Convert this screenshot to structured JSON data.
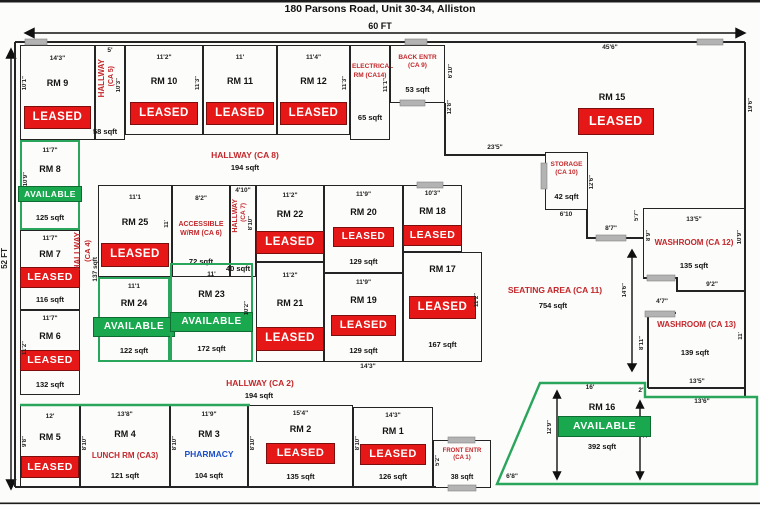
{
  "title": "180 Parsons Road, Unit 30-34, Alliston",
  "overall": {
    "width_label": "60 FT",
    "height_label": "52 FT"
  },
  "hallways": {
    "ca8": {
      "name": "HALLWAY (CA 8)",
      "sqft": "194 sqft"
    },
    "ca2": {
      "name": "HALLWAY (CA 2)",
      "sqft": "194 sqft"
    },
    "ca5": {
      "l1": "HALLWAY",
      "l2": "(CA 5)",
      "top": "5'",
      "side": "10'3\"",
      "sqft": "58 sqft"
    },
    "ca7": {
      "l1": "HALLWAY",
      "l2": "(CA 7)",
      "top": "4'10\"",
      "side": "8'10\"",
      "sqft": "40 sqft"
    },
    "ca4": {
      "l1": "HALLWAY",
      "l2": "(CA 4)",
      "sqft": "137 sqft"
    }
  },
  "areas": {
    "seating_ca11": {
      "name": "SEATING AREA (CA 11)",
      "sqft": "754 sqft"
    },
    "electrical_ca14": {
      "name": "ELECTRICAL RM (CA14)",
      "sqft": "65 sqft",
      "side": "11'1\""
    },
    "back_entr_ca9": {
      "name": "BACK ENTR (CA 9)",
      "sqft": "53 sqft",
      "side": "6'10\""
    },
    "storage_ca10": {
      "name": "STORAGE (CA 10)",
      "sqft": "42 sqft",
      "bottom": "6'10",
      "side": "12'6\""
    },
    "washroom_ca12": {
      "name": "WASHROOM (CA 12)",
      "top": "13'5\"",
      "sqft": "135 sqft",
      "side": "10'9\"",
      "bottom": "9'2\"",
      "door": "8'7\"",
      "wall_a": "5'7\"",
      "wall_b": "8'9\""
    },
    "washroom_ca13": {
      "name": "WASHROOM (CA 13)",
      "sqft": "139 sqft",
      "bottom": "13'5\"",
      "side": "11'",
      "door": "4'7\"",
      "wall_a": "8'11\"",
      "arrow": "14'6\""
    },
    "front_entr_ca1": {
      "name": "FRONT ENTR (CA 1)",
      "sqft": "38 sqft",
      "side": "5'2\""
    }
  },
  "rooms": {
    "rm9": {
      "name": "RM 9",
      "top": "14'3\"",
      "side": "10'1\"",
      "status": "LEASED"
    },
    "rm10": {
      "name": "RM 10",
      "top": "11'2\"",
      "side": "11'3\"",
      "status": "LEASED"
    },
    "rm11": {
      "name": "RM 11",
      "top": "11'",
      "status": "LEASED"
    },
    "rm12": {
      "name": "RM 12",
      "top": "11'4\"",
      "side": "11'3\"",
      "status": "LEASED"
    },
    "rm15": {
      "name": "RM 15",
      "status": "LEASED",
      "top": "45'6\"",
      "side_right": "19'6\"",
      "side_left": "12'8\"",
      "wall": "23'5\""
    },
    "rm8": {
      "name": "RM 8",
      "top": "11'7\"",
      "side": "10'9\"",
      "sqft": "125 sqft",
      "status": "AVAILABLE"
    },
    "rm7": {
      "name": "RM 7",
      "top": "11'7\"",
      "sqft": "116 sqft",
      "status": "LEASED"
    },
    "rm6": {
      "name": "RM 6",
      "top": "11'7\"",
      "side": "11'2\"",
      "sqft": "132 sqft",
      "status": "LEASED"
    },
    "rm25": {
      "name": "RM 25",
      "top": "11'1",
      "side": "11'",
      "status": "LEASED"
    },
    "accessible_ca6": {
      "name": "ACCESSIBLE W/RM (CA 6)",
      "top": "8'2\"",
      "sqft": "72 sqft"
    },
    "rm22": {
      "name": "RM 22",
      "top": "11'2\"",
      "status": "LEASED"
    },
    "rm20": {
      "name": "RM 20",
      "top": "11'9\"",
      "sqft": "129 sqft",
      "status": "LEASED"
    },
    "rm18": {
      "name": "RM 18",
      "top": "10'3\"",
      "status": "LEASED"
    },
    "rm24": {
      "name": "RM 24",
      "top": "11'1",
      "sqft": "122 sqft",
      "status": "AVAILABLE"
    },
    "rm23": {
      "name": "RM 23",
      "top": "11'",
      "side": "10'2\"",
      "sqft": "172 sqft",
      "status": "AVAILABLE"
    },
    "rm21": {
      "name": "RM 21",
      "top": "11'2\"",
      "status": "LEASED"
    },
    "rm19": {
      "name": "RM 19",
      "top": "11'9\"",
      "sqft": "129 sqft",
      "status": "LEASED"
    },
    "rm17": {
      "name": "RM 17",
      "side": "11'2\"",
      "bottom": "14'3\"",
      "sqft": "167 sqft",
      "status": "LEASED"
    },
    "rm5": {
      "name": "RM 5",
      "top": "12'",
      "side": "9'8\"",
      "status": "LEASED"
    },
    "rm4": {
      "name": "RM 4",
      "top": "13'8\"",
      "side": "8'10\"",
      "type": "LUNCH RM (CA3)",
      "sqft": "121 sqft"
    },
    "rm3": {
      "name": "RM 3",
      "top": "11'9\"",
      "side": "8'10\"",
      "type": "PHARMACY",
      "sqft": "104 sqft"
    },
    "rm2": {
      "name": "RM 2",
      "top": "15'4\"",
      "side": "8'10\"",
      "sqft": "135 sqft",
      "status": "LEASED"
    },
    "rm1": {
      "name": "RM 1",
      "top": "14'3\"",
      "side": "8'10\"",
      "sqft": "126 sqft",
      "status": "LEASED"
    },
    "rm16": {
      "name": "RM 16",
      "sqft": "392 sqft",
      "status": "AVAILABLE",
      "top": "16'",
      "step": "2'",
      "right_top": "13'6\"",
      "side_left": "12'9\"",
      "side_right": "10'",
      "bottom": "6'8\""
    }
  },
  "colors": {
    "leased_red": "#e61717",
    "available_green": "#19a84e",
    "label_red": "#c3272b",
    "pharmacy_blue": "#1c50c8",
    "wall_green": "#2aa65c"
  }
}
